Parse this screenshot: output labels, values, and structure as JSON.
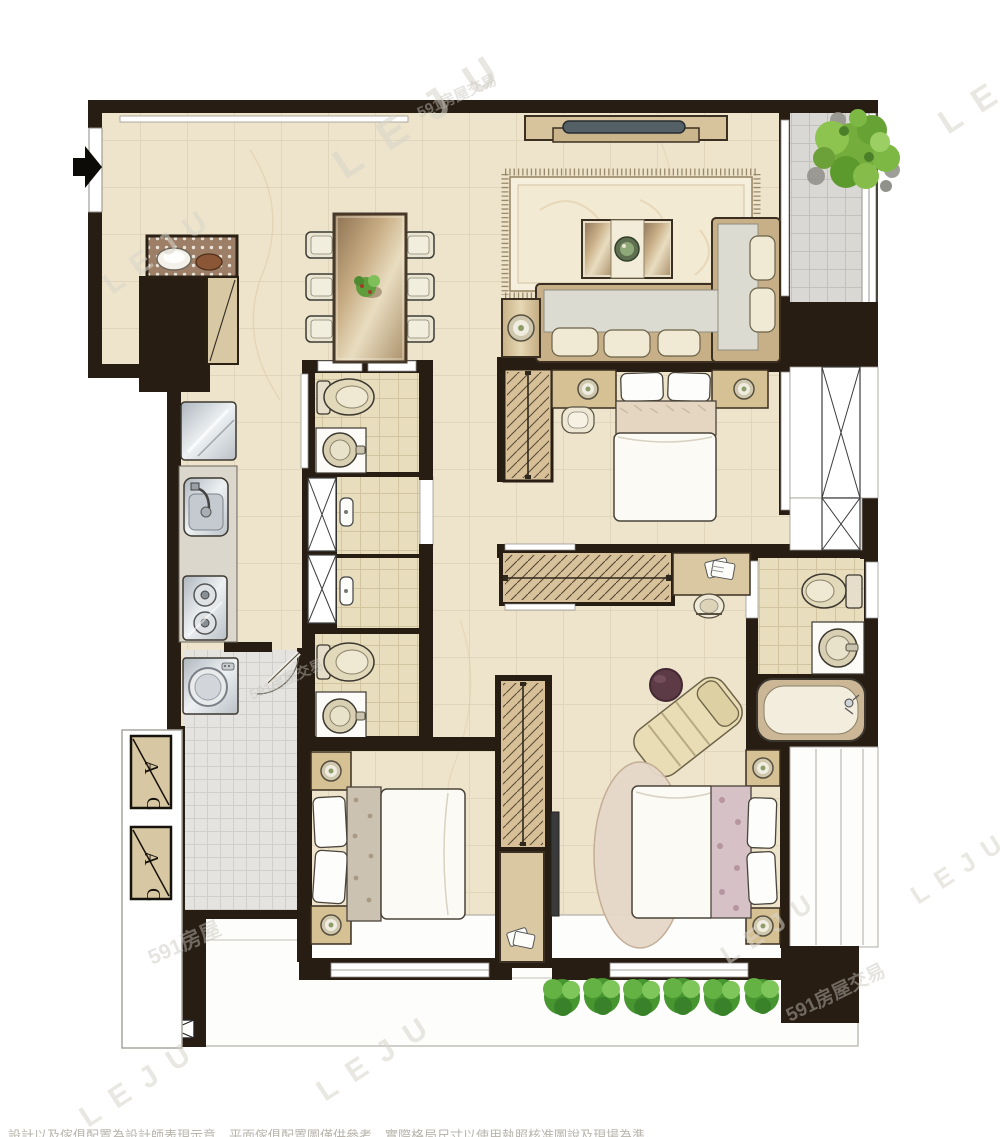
{
  "watermarks": {
    "leju": "LEJU",
    "site591": "591房屋交易",
    "site591_short": "591房屋"
  },
  "ac_unit": {
    "letter_a": "A",
    "letter_c": "C"
  },
  "footer": {
    "disclaimer": "設計以及傢俱配置為設計師表現示意，平面傢俱配置圖僅供參考，實際格局尺寸以使用執照核准圖說及現場為準。"
  },
  "colors": {
    "wall": "#271d13",
    "floor": "#eee4cb",
    "bath_tile": "#e8ddbd",
    "gray_tile": "#d9d8d4",
    "utility_tile": "#e4e3e0",
    "wood": "#d7c098",
    "plant_green": "#74ad3b",
    "ottoman": "#5d3b46"
  }
}
